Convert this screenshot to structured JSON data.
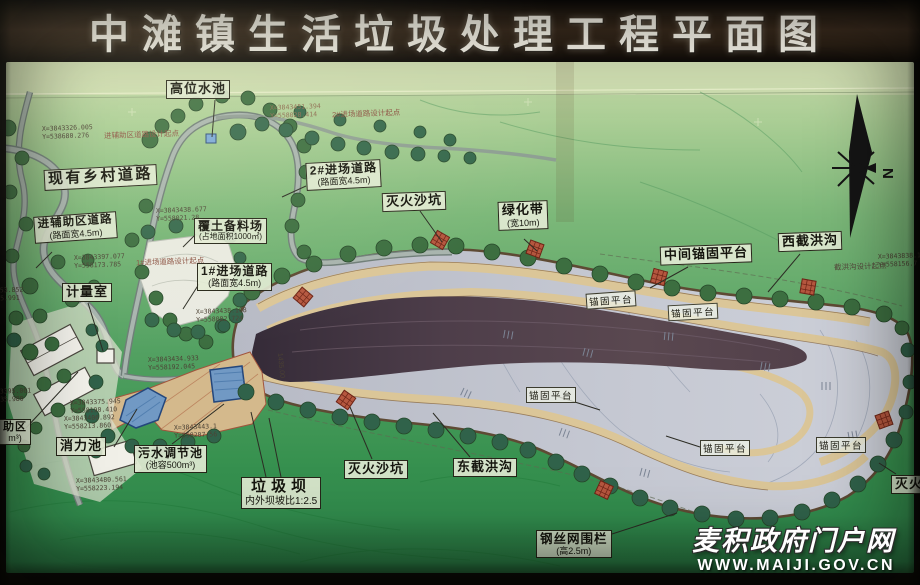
{
  "header": {
    "title": "中滩镇生活垃圾处理工程平面图"
  },
  "map": {
    "labels": {
      "high_water_tank": {
        "title": "高位水池"
      },
      "existing_village_road": {
        "title": "现有乡村道路"
      },
      "aux_area_road": {
        "title": "进辅助区道路",
        "sub": "(路面宽4.5m)"
      },
      "entry_road_2": {
        "title": "2#进场道路",
        "sub": "(路面宽4.5m)"
      },
      "fire_sand_pit_top": {
        "title": "灭火沙坑"
      },
      "green_belt": {
        "title": "绿化带",
        "sub": "(宽10m)"
      },
      "middle_anchor_platform": {
        "title": "中间锚固平台"
      },
      "west_flood_ditch": {
        "title": "西截洪沟"
      },
      "soil_stock_yard": {
        "title": "覆土备料场",
        "sub": "(占地面积1000㎡)"
      },
      "entry_road_1": {
        "title": "1#进场道路",
        "sub": "(路面宽4.5m)"
      },
      "metering_room": {
        "title": "计量室"
      },
      "stilling_pool": {
        "title": "消力池"
      },
      "sewage_pool": {
        "title": "污水调节池",
        "sub": "(池容500m³)"
      },
      "garbage_dam": {
        "title": "垃圾坝",
        "sub": "内外坝坡比1:2.5"
      },
      "fire_sand_pit_bottom": {
        "title": "灭火沙坑"
      },
      "east_flood_ditch": {
        "title": "东截洪沟"
      },
      "wire_fence": {
        "title": "钢丝网围栏",
        "sub": "(高2.5m)"
      },
      "fire_sand_pit_right": {
        "title": "灭火沙坑"
      },
      "aux_zone_cut": {
        "title": "助区",
        "sub": "m³)"
      }
    },
    "platform_label": "锚固平台",
    "compass_n": "N",
    "elevation": "1435.00",
    "coords": {
      "c1": {
        "x": "X=3843326.005",
        "y": "Y=538680.276",
        "note": "进辅助区道路设计起点"
      },
      "c2": {
        "x": "X=3843451.394",
        "y": "Y=558028.414",
        "note": "2#进场道路设计起点"
      },
      "c3": {
        "x": "X=3843397.077",
        "y": "Y=558173.785",
        "note": "1#进场道路设计起点"
      },
      "c4": {
        "x": "X=3843438.677",
        "y": "Y=558021.28"
      },
      "c5": {
        "x": "X=3843438.108",
        "y": "Y=558082.724"
      },
      "c6": {
        "x": "X=3843375.945",
        "y": "Y=558190.410"
      },
      "c7": {
        "x": "X=3843406.892",
        "y": "Y=558213.860"
      },
      "c8": {
        "x": "X=3843480.561",
        "y": "Y=558223.194"
      },
      "c9": {
        "x": "X=3843838.1",
        "y": "Y=558156.7",
        "note": "截洪沟设计起点"
      },
      "c10": {
        "x": "X=3843434.933",
        "y": "Y=558192.045"
      },
      "c11": {
        "x": "X=3843443.1",
        "y": "Y=558207.56"
      },
      "f1": {
        "x": "3395.061",
        "y": "35.980"
      },
      "f2": {
        "x": "53.852",
        "y": "5.991"
      }
    },
    "watermark": {
      "line1": "麦积政府门户网",
      "line2": "WWW.MAIJI.GOV.CN"
    }
  }
}
